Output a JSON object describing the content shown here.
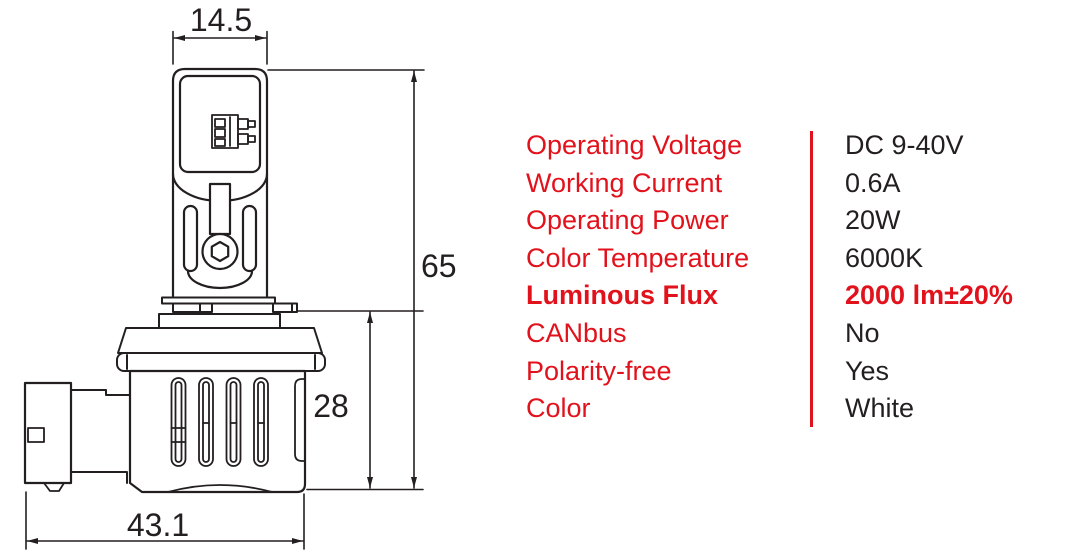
{
  "colors": {
    "accent_red": "#e2121c",
    "ink_black": "#231f20",
    "background": "#ffffff"
  },
  "drawing": {
    "description": "LED headlight bulb technical dimension drawing",
    "dim_top_width": "14.5",
    "dim_total_height": "65",
    "dim_body_height": "28",
    "dim_total_length": "43.1"
  },
  "specs": {
    "rows": [
      {
        "label": "Operating Voltage",
        "value": "DC 9-40V"
      },
      {
        "label": "Working Current",
        "value": "0.6A"
      },
      {
        "label": "Operating Power",
        "value": "20W"
      },
      {
        "label": "Color Temperature",
        "value": "6000K"
      },
      {
        "label": "Luminous Flux",
        "value": "2000 lm±20%"
      },
      {
        "label": "CANbus",
        "value": "No"
      },
      {
        "label": "Polarity-free",
        "value": "Yes"
      },
      {
        "label": "Color",
        "value": "White"
      }
    ]
  }
}
